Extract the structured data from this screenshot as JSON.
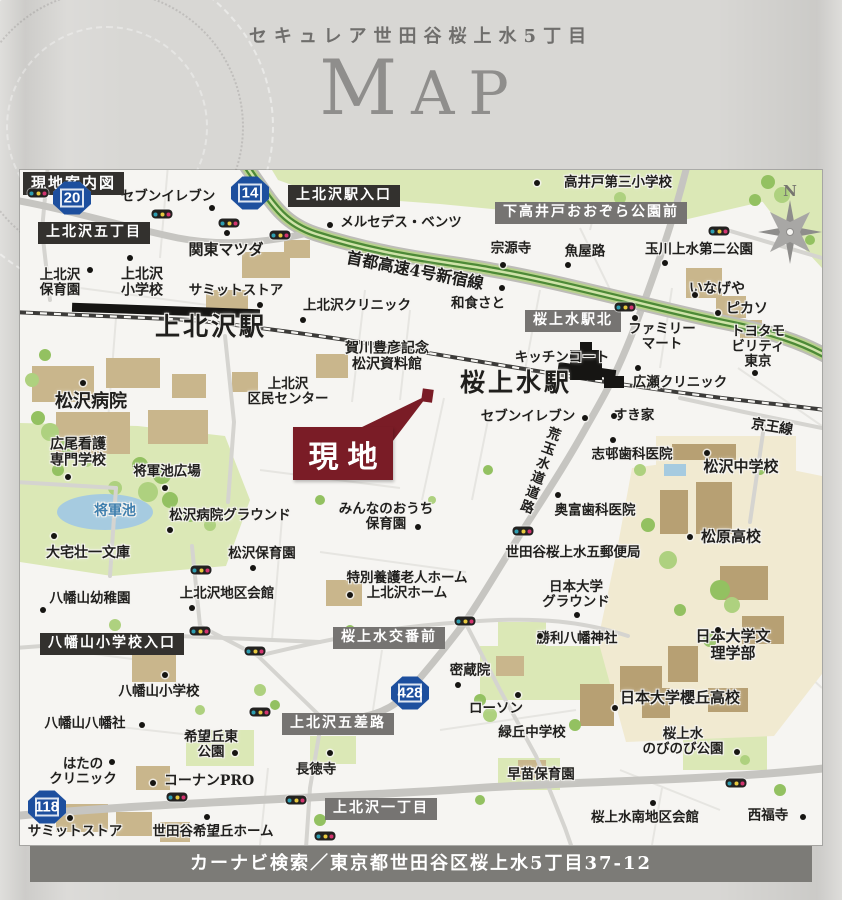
{
  "page": {
    "subtitle": "セキュレア世田谷桜上水5丁目",
    "title": "MAP"
  },
  "footer": {
    "text": "カーナビ検索／東京都世田谷区桜上水5丁目37-12"
  },
  "colors": {
    "site": "#7a1c26",
    "banner_dark": "#33312e",
    "banner_gray": "#767472",
    "shield_blue": "#1d4f9e",
    "highway_green": "#4d8a37",
    "park_green": "#dbe8b6",
    "building_tan": "#c9b68c",
    "water_blue": "#a6cbe0",
    "rail_black": "#3c3b39",
    "map_bg": "#f6f5f2",
    "page_bg": "#d8d7d4",
    "footer_bg": "#7c7b77"
  },
  "map": {
    "site_label": "現地",
    "compass": "N",
    "banners": [
      {
        "t": "現地案内図",
        "x": 3,
        "y": 2,
        "v": "dark",
        "s": 15
      },
      {
        "t": "上北沢五丁目",
        "x": 18,
        "y": 52,
        "v": "dark"
      },
      {
        "t": "上北沢駅入口",
        "x": 268,
        "y": 15,
        "v": "dark"
      },
      {
        "t": "下高井戸おおぞら公園前",
        "x": 475,
        "y": 32,
        "v": "gray"
      },
      {
        "t": "桜上水駅北",
        "x": 505,
        "y": 140,
        "v": "gray"
      },
      {
        "t": "八幡山小学校入口",
        "x": 20,
        "y": 463,
        "v": "dark"
      },
      {
        "t": "桜上水交番前",
        "x": 313,
        "y": 457,
        "v": "gray"
      },
      {
        "t": "上北沢五差路",
        "x": 262,
        "y": 543,
        "v": "gray"
      },
      {
        "t": "上北沢一丁目",
        "x": 305,
        "y": 628,
        "v": "gray"
      }
    ],
    "shields": [
      {
        "n": "20",
        "x": 52,
        "y": 28
      },
      {
        "n": "14",
        "x": 230,
        "y": 23
      },
      {
        "n": "118",
        "x": 27,
        "y": 637
      },
      {
        "n": "428",
        "x": 390,
        "y": 523
      }
    ],
    "labels": [
      {
        "t": "セブンイレブン",
        "x": 148,
        "y": 27
      },
      {
        "t": "メルセデス・ベンツ",
        "x": 381,
        "y": 53
      },
      {
        "t": "高井戸第三小学校",
        "x": 598,
        "y": 13
      },
      {
        "t": "宗源寺",
        "x": 491,
        "y": 79
      },
      {
        "t": "魚屋路",
        "x": 565,
        "y": 82
      },
      {
        "t": "玉川上水第二公園",
        "x": 679,
        "y": 80
      },
      {
        "t": "関東マツダ",
        "x": 206,
        "y": 80,
        "s": 15
      },
      {
        "t": "上北沢\n保育園",
        "x": 40,
        "y": 113
      },
      {
        "t": "上北沢\n小学校",
        "x": 122,
        "y": 113,
        "s": 14
      },
      {
        "t": "サミットストア",
        "x": 216,
        "y": 121
      },
      {
        "t": "上北沢クリニック",
        "x": 337,
        "y": 136
      },
      {
        "t": "和食さと",
        "x": 458,
        "y": 134
      },
      {
        "t": "いなげや",
        "x": 697,
        "y": 120,
        "s": 14
      },
      {
        "t": "ピカソ",
        "x": 727,
        "y": 140,
        "s": 14
      },
      {
        "t": "ファミリー\nマート",
        "x": 642,
        "y": 167
      },
      {
        "t": "トヨタモビリティ\n東京",
        "x": 738,
        "y": 177
      },
      {
        "t": "上北沢駅",
        "x": 191,
        "y": 157,
        "s": 25,
        "k": "sta"
      },
      {
        "t": "首都高速4号新宿線",
        "x": 395,
        "y": 101,
        "s": 16,
        "r": 11
      },
      {
        "t": "賀川豊彦記念\n松沢資料館",
        "x": 367,
        "y": 187,
        "s": 14
      },
      {
        "t": "キッチンコート",
        "x": 542,
        "y": 188
      },
      {
        "t": "桜上水駅",
        "x": 496,
        "y": 213,
        "s": 25,
        "k": "sta"
      },
      {
        "t": "広瀬クリニック",
        "x": 660,
        "y": 213
      },
      {
        "t": "上北沢\n区民センター",
        "x": 268,
        "y": 222
      },
      {
        "t": "セブンイレブン",
        "x": 508,
        "y": 247
      },
      {
        "t": "すき家",
        "x": 614,
        "y": 246
      },
      {
        "t": "京王線",
        "x": 752,
        "y": 258,
        "s": 14,
        "r": 9
      },
      {
        "t": "松沢病院",
        "x": 71,
        "y": 232,
        "s": 18
      },
      {
        "t": "志邨歯科医院",
        "x": 612,
        "y": 285
      },
      {
        "t": "松沢中学校",
        "x": 721,
        "y": 297,
        "s": 15
      },
      {
        "t": "広尾看護\n専門学校",
        "x": 58,
        "y": 283,
        "s": 14
      },
      {
        "t": "将軍池広場",
        "x": 147,
        "y": 302
      },
      {
        "t": "将軍池",
        "x": 95,
        "y": 342,
        "s": 14,
        "c": "#3f7fae"
      },
      {
        "t": "松沢病院グラウンド",
        "x": 210,
        "y": 346
      },
      {
        "t": "荒玉水道道路",
        "x": 518,
        "y": 300,
        "v": 1,
        "r": 20
      },
      {
        "t": "奥富歯科医院",
        "x": 575,
        "y": 341
      },
      {
        "t": "みんなのおうち\n保育園",
        "x": 366,
        "y": 347
      },
      {
        "t": "世田谷桜上水五郵便局",
        "x": 553,
        "y": 383
      },
      {
        "t": "大宅壮一文庫",
        "x": 68,
        "y": 384,
        "s": 14
      },
      {
        "t": "松沢保育園",
        "x": 242,
        "y": 384
      },
      {
        "t": "松原高校",
        "x": 711,
        "y": 367,
        "s": 15
      },
      {
        "t": "特別養護老人ホーム\n上北沢ホーム",
        "x": 387,
        "y": 416
      },
      {
        "t": "八幡山幼稚園",
        "x": 70,
        "y": 429
      },
      {
        "t": "上北沢地区会館",
        "x": 207,
        "y": 424
      },
      {
        "t": "日本大学\nグラウンド",
        "x": 556,
        "y": 425
      },
      {
        "t": "勝利八幡神社",
        "x": 557,
        "y": 469
      },
      {
        "t": "日本大学文理学部",
        "x": 713,
        "y": 475,
        "s": 15
      },
      {
        "t": "八幡山小学校",
        "x": 139,
        "y": 522
      },
      {
        "t": "密蔵院",
        "x": 450,
        "y": 501
      },
      {
        "t": "ローソン",
        "x": 476,
        "y": 539
      },
      {
        "t": "日本大学櫻丘高校",
        "x": 660,
        "y": 528,
        "s": 15
      },
      {
        "t": "八幡山八幡社",
        "x": 65,
        "y": 554
      },
      {
        "t": "緑丘中学校",
        "x": 512,
        "y": 563
      },
      {
        "t": "桜上水\nのびのび公園",
        "x": 663,
        "y": 572
      },
      {
        "t": "希望丘東\n公園",
        "x": 191,
        "y": 575
      },
      {
        "t": "はたの\nクリニック",
        "x": 63,
        "y": 602
      },
      {
        "t": "コーナンPRO",
        "x": 189,
        "y": 612,
        "s": 14
      },
      {
        "t": "長徳寺",
        "x": 296,
        "y": 600
      },
      {
        "t": "早苗保育園",
        "x": 521,
        "y": 605
      },
      {
        "t": "サミットストア",
        "x": 55,
        "y": 662
      },
      {
        "t": "世田谷希望丘ホーム",
        "x": 193,
        "y": 662
      },
      {
        "t": "桜上水南地区会館",
        "x": 625,
        "y": 648
      },
      {
        "t": "西福寺",
        "x": 748,
        "y": 646
      }
    ],
    "signals": [
      [
        18,
        23
      ],
      [
        142,
        44
      ],
      [
        209,
        53
      ],
      [
        260,
        65
      ],
      [
        605,
        137
      ],
      [
        699,
        61
      ],
      [
        181,
        400
      ],
      [
        180,
        461
      ],
      [
        235,
        481
      ],
      [
        445,
        451
      ],
      [
        503,
        361
      ],
      [
        157,
        627
      ],
      [
        276,
        630
      ],
      [
        305,
        666
      ],
      [
        716,
        613
      ],
      [
        240,
        542
      ]
    ],
    "dots": [
      [
        192,
        38
      ],
      [
        310,
        55
      ],
      [
        517,
        13
      ],
      [
        483,
        95
      ],
      [
        548,
        95
      ],
      [
        645,
        93
      ],
      [
        207,
        63
      ],
      [
        70,
        100
      ],
      [
        110,
        88
      ],
      [
        240,
        135
      ],
      [
        283,
        150
      ],
      [
        482,
        118
      ],
      [
        675,
        125
      ],
      [
        698,
        143
      ],
      [
        615,
        148
      ],
      [
        735,
        203
      ],
      [
        618,
        198
      ],
      [
        594,
        246
      ],
      [
        565,
        248
      ],
      [
        593,
        270
      ],
      [
        538,
        325
      ],
      [
        687,
        283
      ],
      [
        63,
        213
      ],
      [
        48,
        307
      ],
      [
        145,
        318
      ],
      [
        150,
        360
      ],
      [
        34,
        366
      ],
      [
        233,
        398
      ],
      [
        23,
        440
      ],
      [
        172,
        438
      ],
      [
        145,
        505
      ],
      [
        122,
        555
      ],
      [
        215,
        583
      ],
      [
        92,
        592
      ],
      [
        133,
        613
      ],
      [
        50,
        648
      ],
      [
        187,
        647
      ],
      [
        310,
        583
      ],
      [
        438,
        515
      ],
      [
        498,
        525
      ],
      [
        520,
        466
      ],
      [
        398,
        357
      ],
      [
        330,
        425
      ],
      [
        557,
        445
      ],
      [
        670,
        367
      ],
      [
        698,
        460
      ],
      [
        595,
        538
      ],
      [
        717,
        582
      ],
      [
        633,
        633
      ],
      [
        783,
        647
      ]
    ]
  }
}
